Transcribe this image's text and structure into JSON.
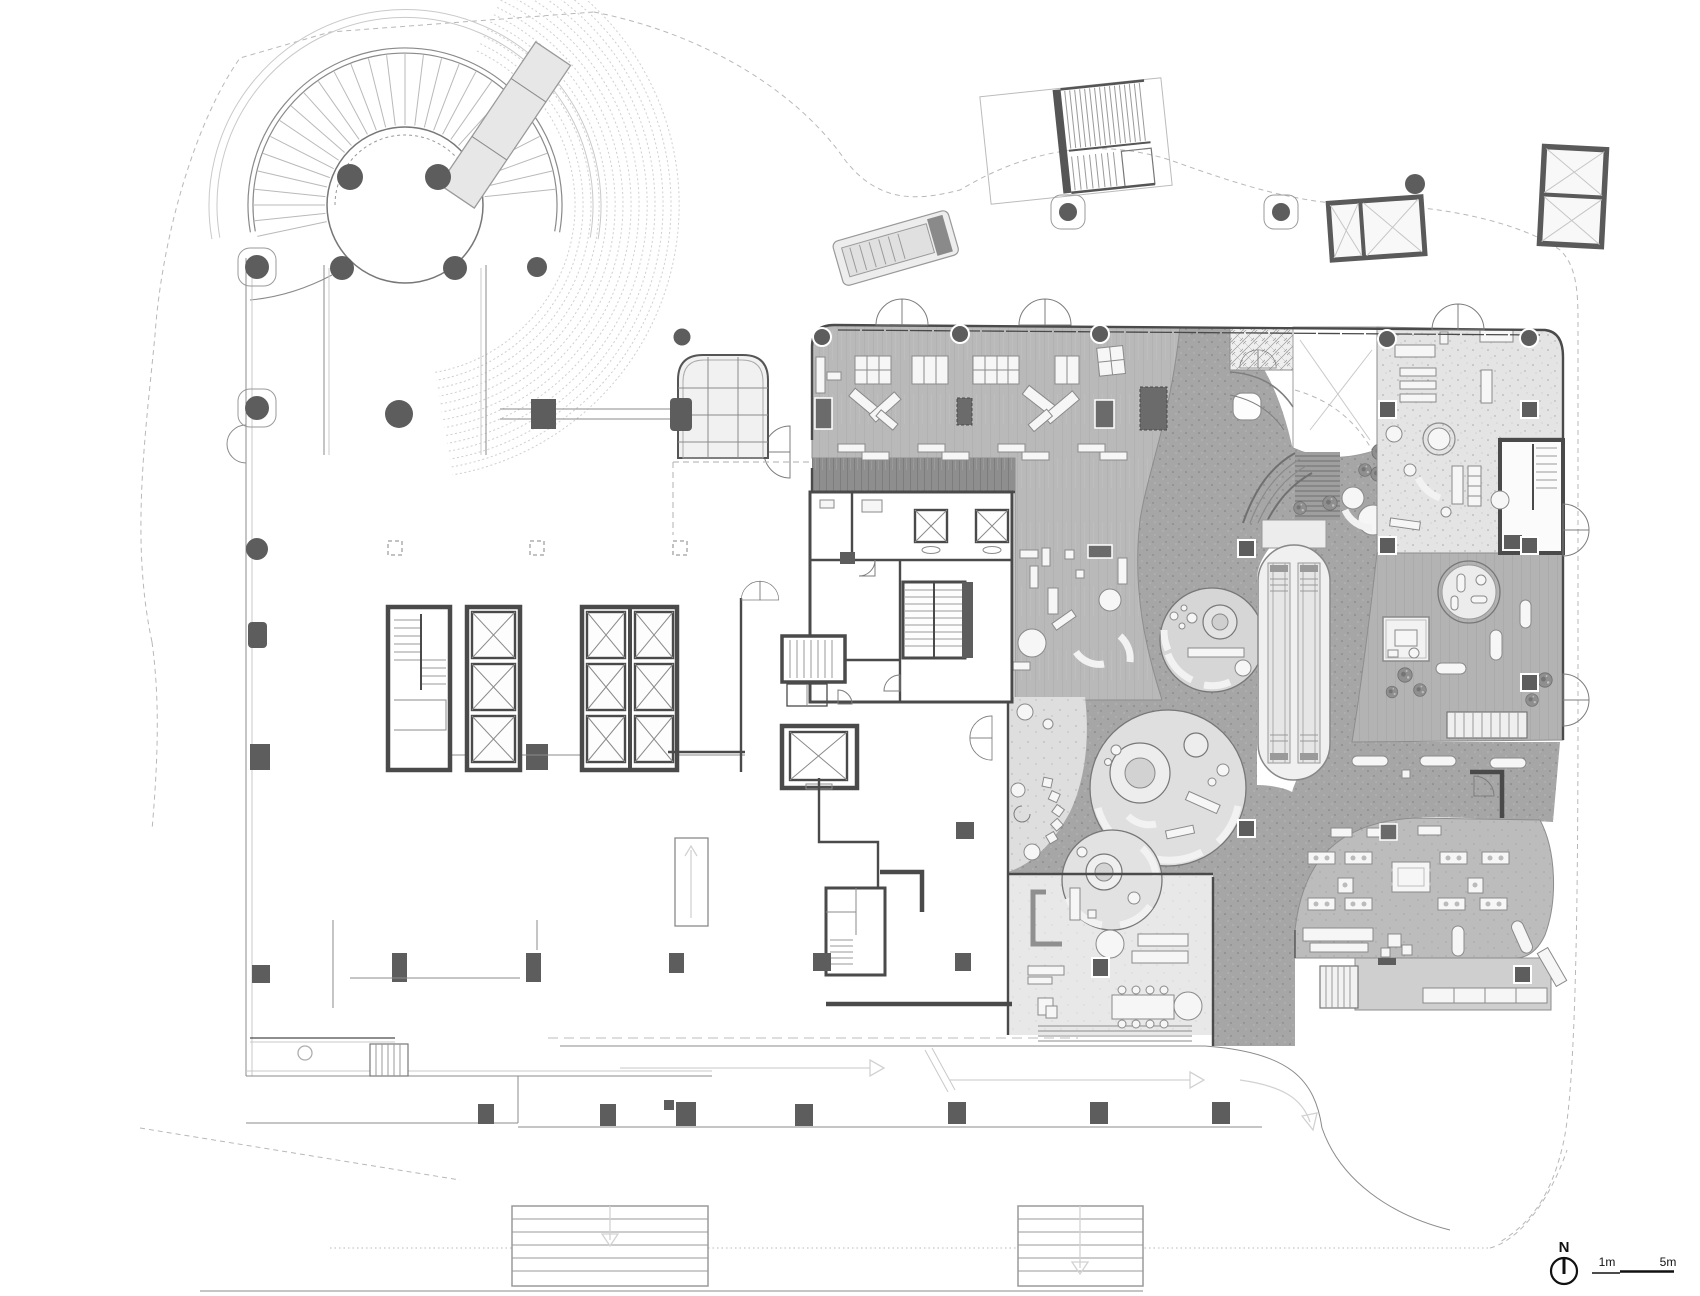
{
  "labels": {
    "north": "N",
    "scale_1m": "1m",
    "scale_5m": "5m"
  },
  "colors": {
    "background": "#ffffff",
    "wall_ink": "#4a4a4a",
    "column_fill": "#5d5d5d",
    "site_boundary": "#b8b8b8",
    "wood_floor": "#b9b9b9",
    "dark_wood_band": "#8e8e8e",
    "dark_path_floor": "#a6a6a6",
    "terrazzo_floor": "#e4e4e4",
    "pebble_floor": "#dedede",
    "lounge_floor": "#e8e8e8",
    "cafe_floor": "#bcbcbc",
    "furniture_fill": "#f6f6f6"
  },
  "compass": {
    "icon": "north-arrow-icon",
    "label": "N"
  },
  "scale_bar": {
    "ticks": [
      "1m",
      "5m"
    ]
  }
}
